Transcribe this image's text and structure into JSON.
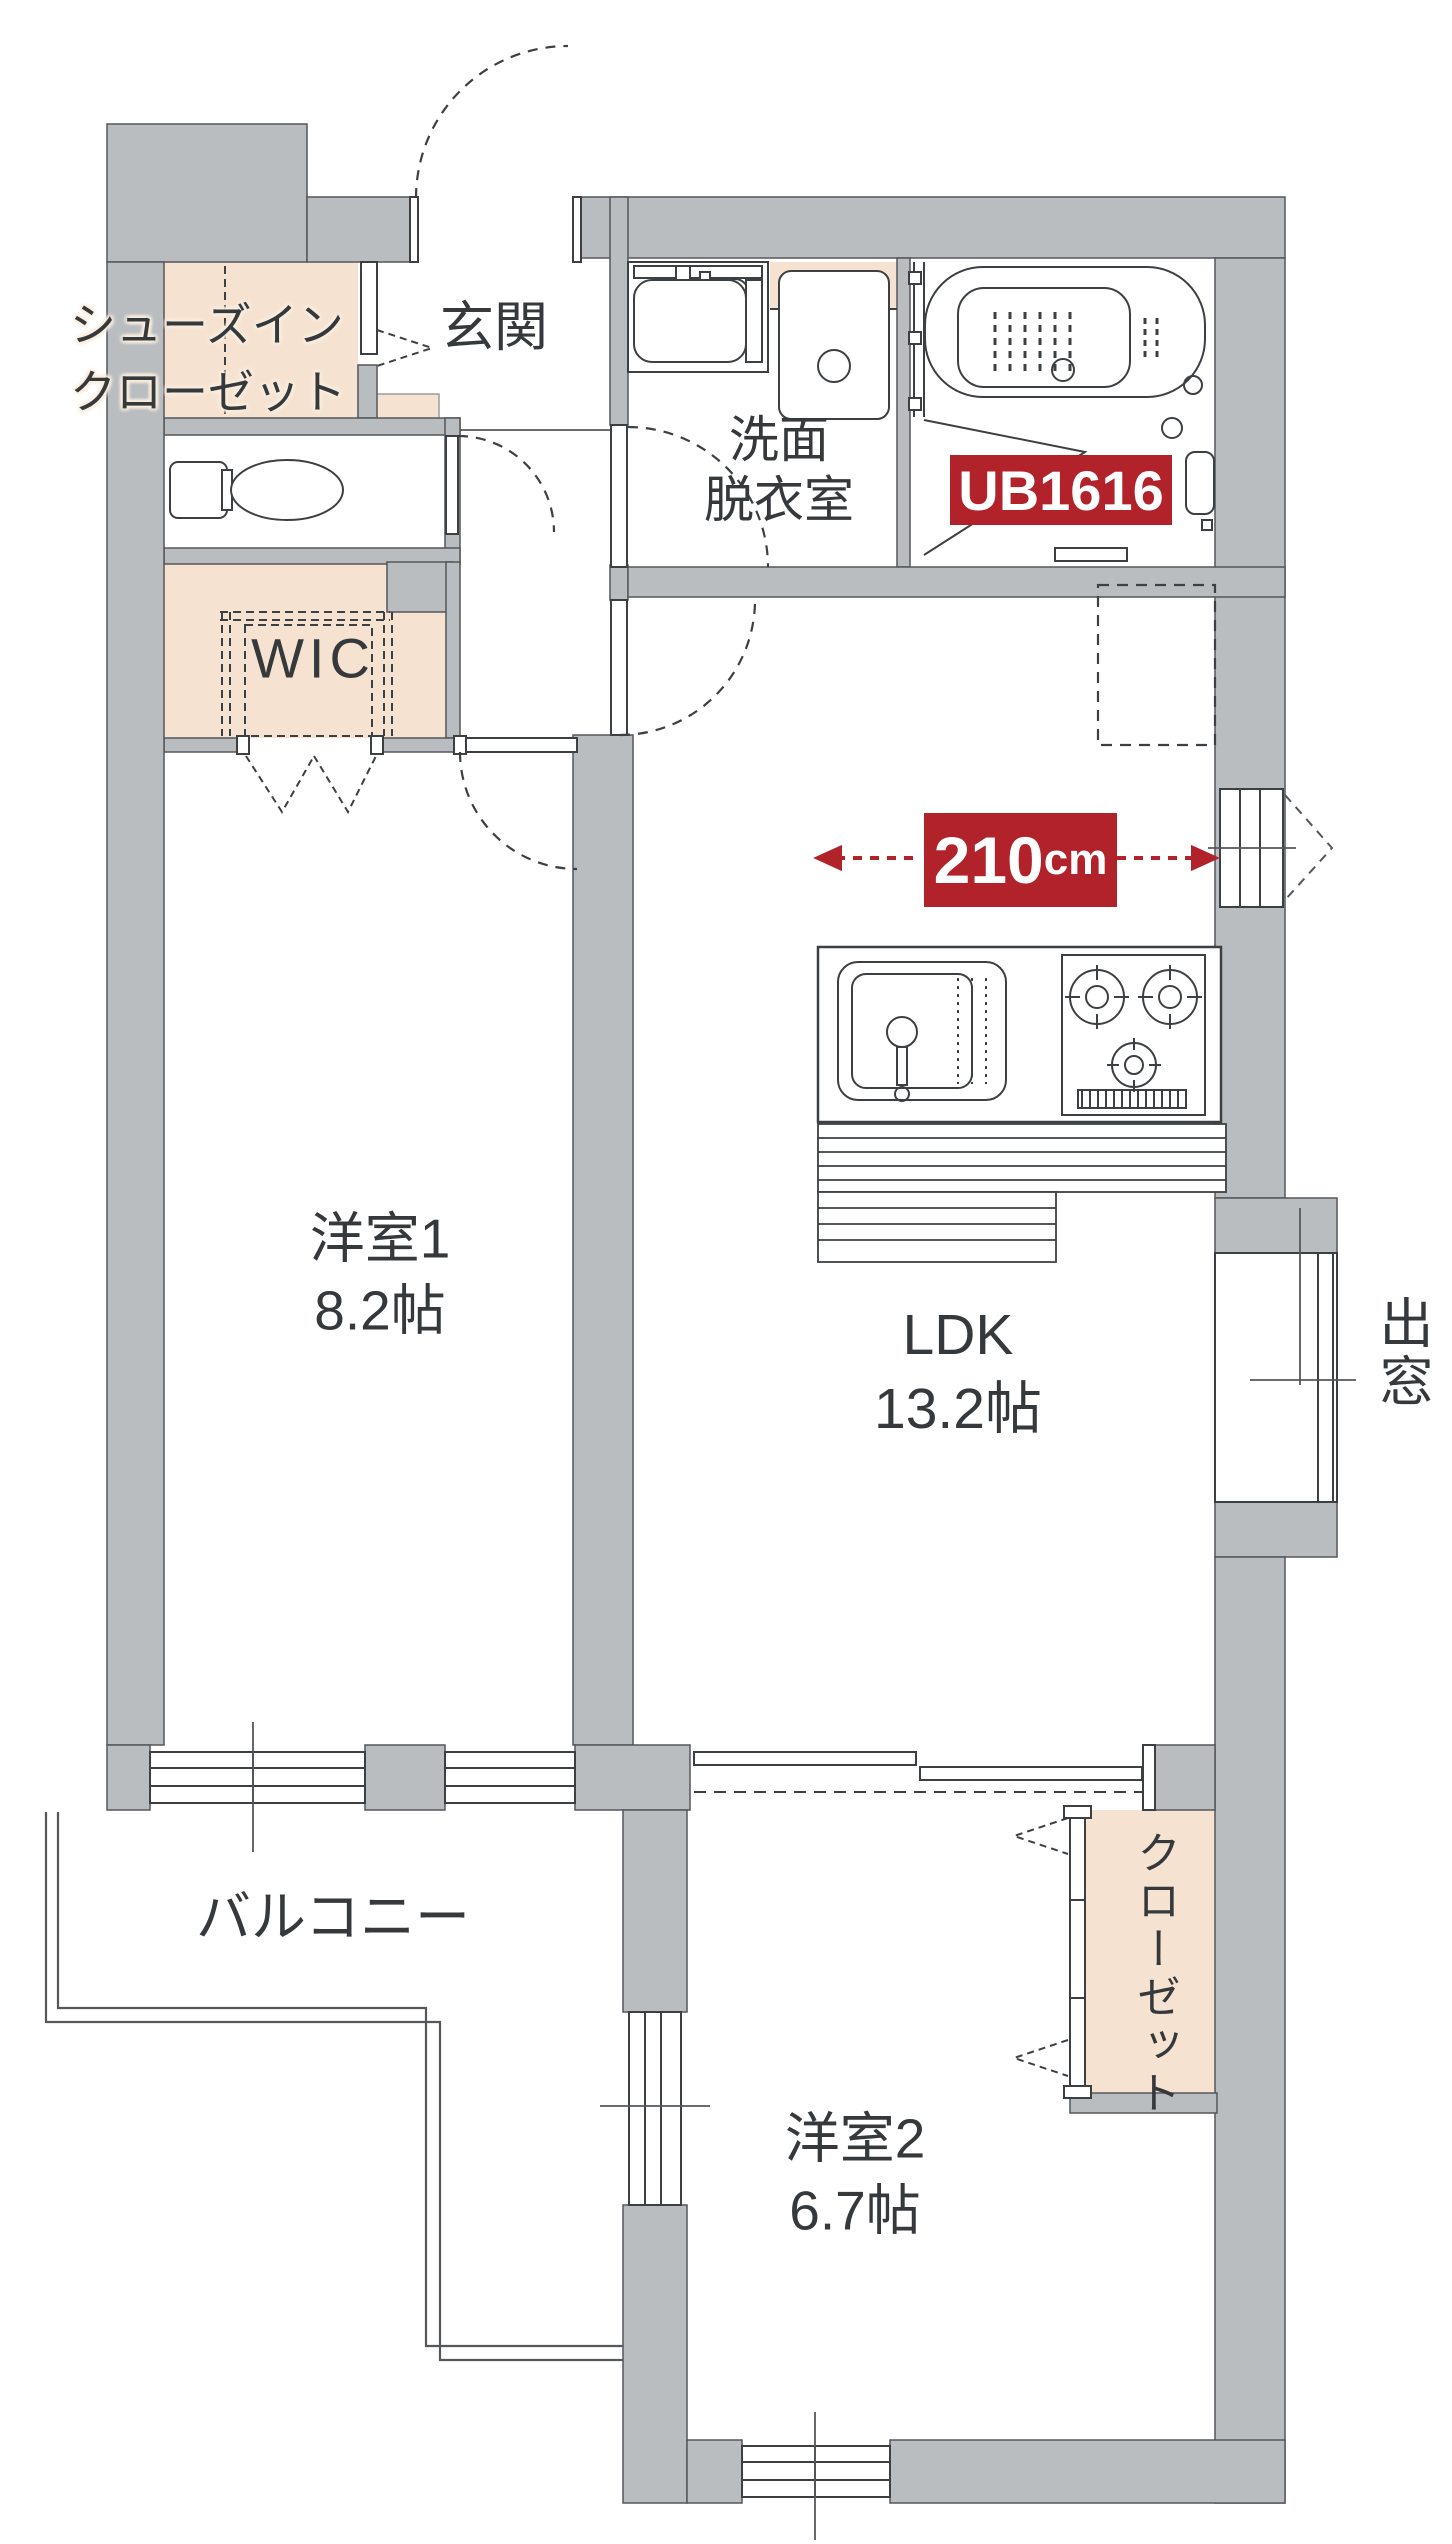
{
  "colors": {
    "wall_fill": "#b9bdc0",
    "wall_edge": "#54575a",
    "closet_fill": "#f6e2d1",
    "accent_red": "#b2222a",
    "line": "#3c4043",
    "text": "#36393b"
  },
  "rooms": {
    "shoes_in_closet": {
      "line1": "シューズイン",
      "line2": "クローゼット"
    },
    "entrance": {
      "label": "玄関"
    },
    "washroom": {
      "line1": "洗面",
      "line2": "脱衣室"
    },
    "unit_bath": {
      "label": "UB1616"
    },
    "wic": {
      "label": "WIC"
    },
    "western_room_1": {
      "name": "洋室1",
      "size": "8.2帖"
    },
    "ldk": {
      "name": "LDK",
      "size": "13.2帖"
    },
    "western_room_2": {
      "name": "洋室2",
      "size": "6.7帖"
    },
    "closet": {
      "label": "クローゼット"
    },
    "balcony": {
      "label": "バルコニー"
    },
    "bay_window": {
      "label": "出窓"
    }
  },
  "dimensions": {
    "kitchen_width": {
      "value": "210",
      "unit": "cm"
    }
  }
}
